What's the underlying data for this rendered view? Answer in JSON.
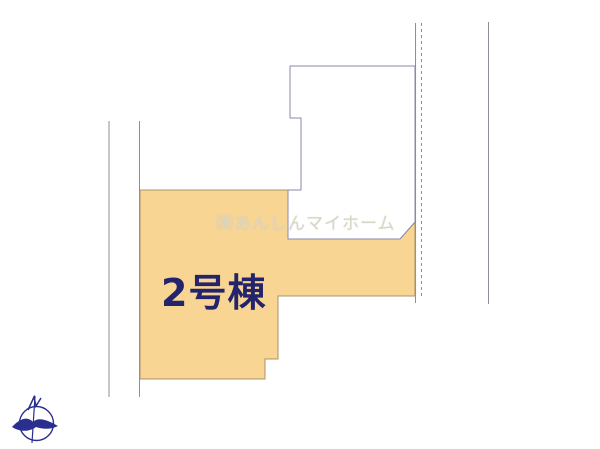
{
  "page": {
    "width_px": 600,
    "height_px": 449,
    "background_color": "#FFFFFF",
    "type": "real-estate lot layout drawing"
  },
  "lot2": {
    "label": "2号棟",
    "fill_color": "#F8D592",
    "border_color": "#A8946C",
    "label_color": "#23246B"
  },
  "neighbor_lot": {
    "fill_color": "#FFFFFF",
    "border_color": "#8A8AA8"
  },
  "watermark": {
    "text": "㈱あんしんマイホーム",
    "color": "#DCD6C6"
  },
  "boundary_lines": {
    "color": "#8E8E98",
    "right_middle_style": "dashed"
  },
  "compass": {
    "icon": "north-compass-icon",
    "color": "#2A2F8F"
  }
}
